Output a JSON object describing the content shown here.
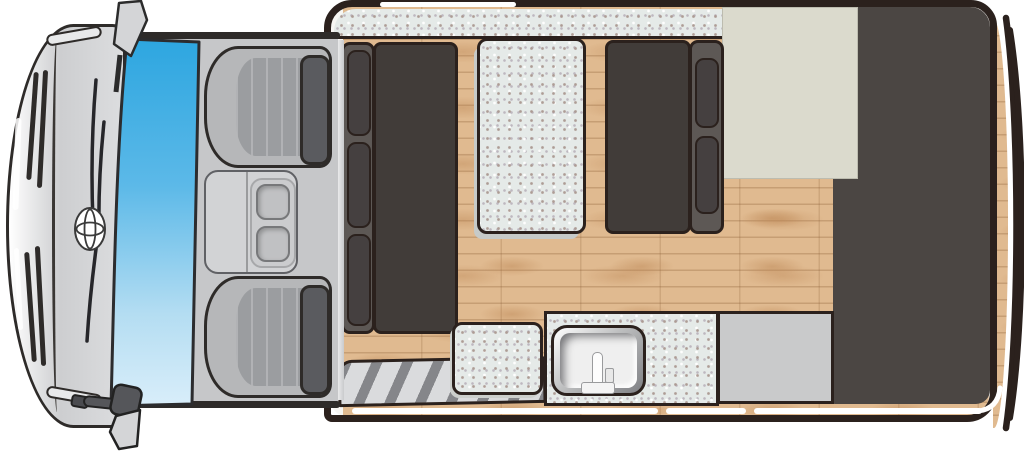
{
  "diagram": {
    "type": "campervan-floorplan-top-view",
    "description": "Top-down floor plan of a Toyota campervan: front cab with two seats and console, living module with facing bench seats, centre bed cushion, entry step mat, kitchen sink counter, table top and rear wardrobe"
  },
  "labels": {
    "vehicle_front": "Vehicle front (hood, grille, bumper)",
    "toyota_emblem": "Toyota emblem",
    "windshield": "Windshield",
    "wipers": "Windshield wipers",
    "mirror_top": "Side mirror (passenger side)",
    "mirror_bottom": "Side mirror (driver side)",
    "passenger_seat": "Passenger cab seat",
    "driver_seat": "Driver cab seat",
    "center_console": "Center console with cup holders",
    "cup_holder_1": "Cup holder",
    "cup_holder_2": "Cup holder",
    "living_module": "Camper living module",
    "over_cab_band": "Upholstered band (over-cab bed edge)",
    "bench_left": "Bench seat (front, facing rear)",
    "bench_right": "Bench seat (rear, facing front)",
    "bed_mattress": "Bed / table cushion",
    "seat_cushion": "Loose seat cushion",
    "entry_step": "Entry step mat",
    "sink": "Kitchen sink with faucet",
    "sink_counter": "Sink counter top",
    "counter_gray": "Counter / appliance top",
    "table_top": "Table top",
    "wardrobe": "Wardrobe / rear cabinet",
    "wood_floor": "Wood floor",
    "rear_wall": "Rear wall",
    "rear_bumper": "Rear bumper"
  },
  "colors": {
    "outline": "#2b211d",
    "body_gray": "#cdced0",
    "windshield_top": "#2da6e0",
    "windshield_bottom": "#d9eefa",
    "bench_dark": "#413c39",
    "backrest_gray": "#5d5855",
    "cushion_dark": "#454040",
    "wood": "#e0ba90",
    "speckle_base": "#e5eae8",
    "cream_panel": "#dbdacd",
    "counter_gray": "#c9cacb",
    "wardrobe_dark": "#4b4643",
    "seat_gray": "#b6b7b9",
    "headrest_gray": "#5a5b5f",
    "step_stripe": "#76777b"
  }
}
